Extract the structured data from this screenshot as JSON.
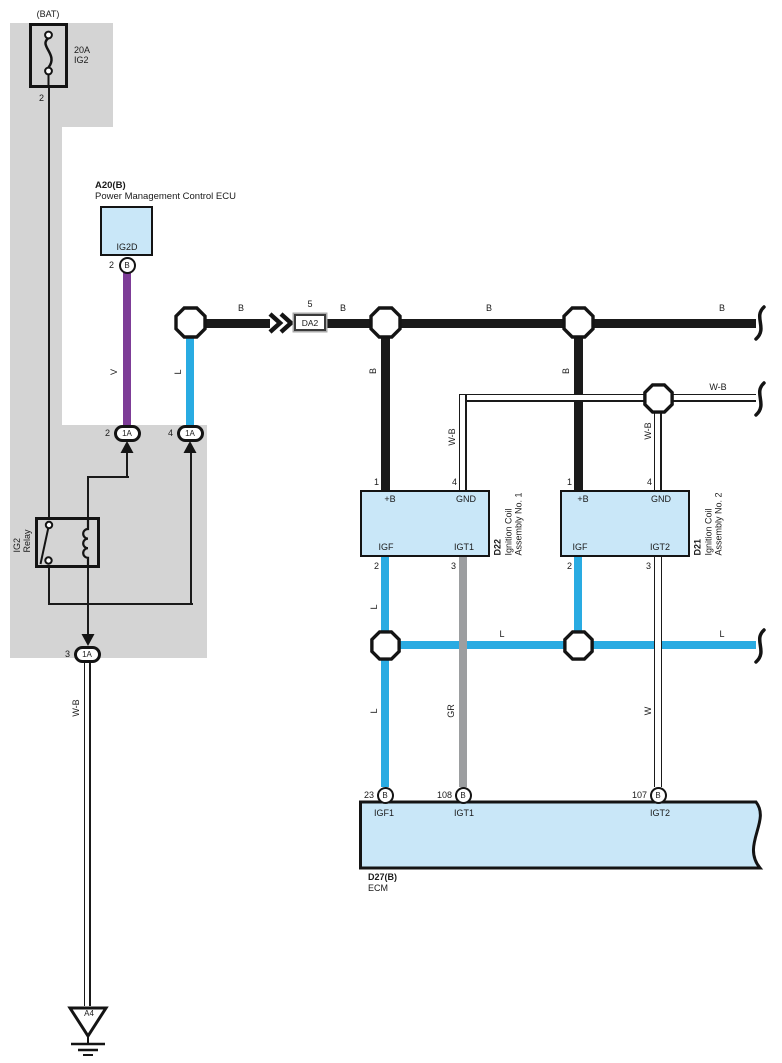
{
  "colors": {
    "black": "#1a1a1a",
    "blue": "#29abe2",
    "purple": "#7d3c97",
    "gray_wire": "#9c9ea0",
    "box_fill": "#c9e7f8",
    "shade": "#d4d4d4"
  },
  "fuse": {
    "bat_label": "(BAT)",
    "amps": "20A",
    "name": "IG2",
    "pin": "2"
  },
  "pmc": {
    "code": "A20(B)",
    "name": "Power Management Control ECU",
    "terminal": "IG2D",
    "pin_no": "2",
    "pin_code": "B"
  },
  "relay": {
    "line1": "IG2",
    "line2": "Relay"
  },
  "ovals": {
    "left": {
      "no": "2",
      "code": "1A"
    },
    "right": {
      "no": "4",
      "code": "1A"
    },
    "bottom": {
      "no": "3",
      "code": "1A"
    }
  },
  "da2": {
    "pin": "5",
    "code": "DA2"
  },
  "wires": {
    "b": "B",
    "wb": "W-B",
    "v": "V",
    "l": "L",
    "gr": "GR",
    "w": "W"
  },
  "coil1": {
    "code": "D22",
    "name1": "Ignition Coil",
    "name2": "Assembly No. 1",
    "pins": {
      "tl_no": "1",
      "tl": "+B",
      "tr_no": "4",
      "tr": "GND",
      "bl_no": "2",
      "bl": "IGF",
      "br_no": "3",
      "br": "IGT1"
    }
  },
  "coil2": {
    "code": "D21",
    "name1": "Ignition Coil",
    "name2": "Assembly No. 2",
    "pins": {
      "tl_no": "1",
      "tl": "+B",
      "tr_no": "4",
      "tr": "GND",
      "bl_no": "2",
      "bl": "IGF",
      "br_no": "3",
      "br": "IGT2"
    }
  },
  "ecm": {
    "code": "D27(B)",
    "name": "ECM",
    "pins": [
      {
        "no": "23",
        "code": "B",
        "label": "IGF1"
      },
      {
        "no": "108",
        "code": "B",
        "label": "IGT1"
      },
      {
        "no": "107",
        "code": "B",
        "label": "IGT2"
      }
    ]
  },
  "ground": {
    "code": "A4"
  }
}
